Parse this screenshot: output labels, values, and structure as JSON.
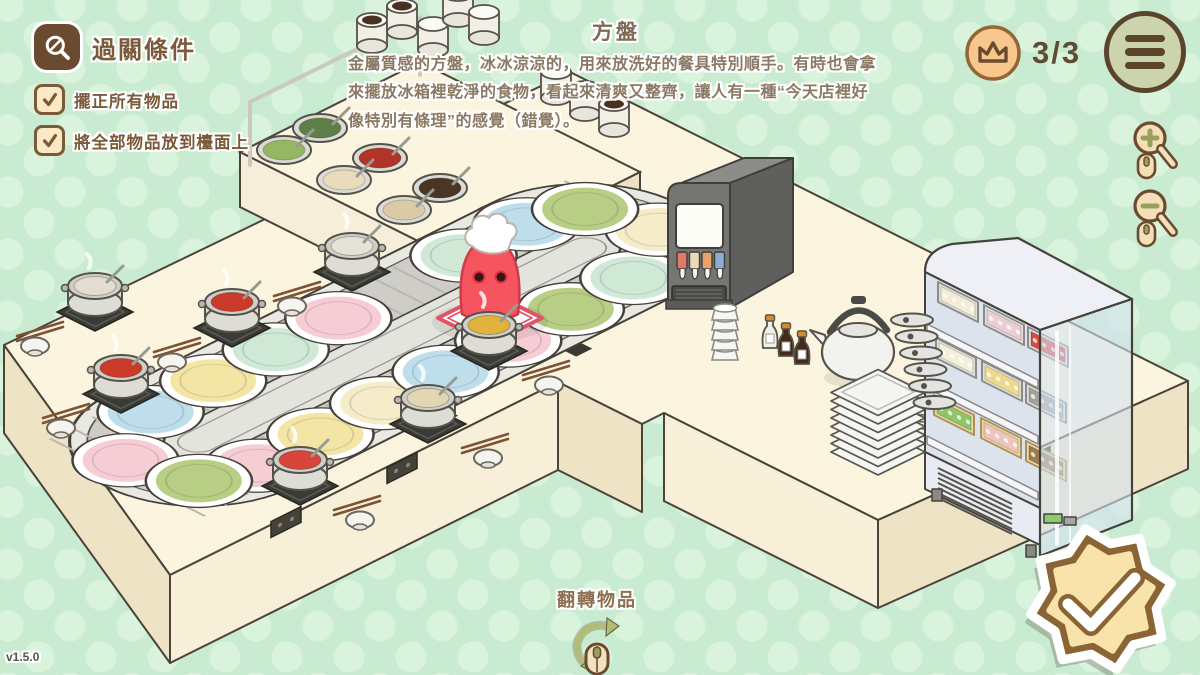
{
  "meta": {
    "version": "v1.5.0"
  },
  "objectives": {
    "title": "過關條件",
    "items": [
      {
        "label": "擺正所有物品",
        "checked": true
      },
      {
        "label": "將全部物品放到檯面上",
        "checked": true
      }
    ]
  },
  "tooltip": {
    "title": "方盤",
    "description": "金屬質感的方盤，冰冰涼涼的，用來放洗好的餐具特別順手。有時也會拿來擺放冰箱裡乾淨的食物，看起來清爽又整齊，讓人有一種“今天店裡好像特別有條理”的感覺（錯覺）。"
  },
  "score": {
    "value": "3/3"
  },
  "hints": {
    "flip_label": "翻轉物品"
  },
  "colors": {
    "accent_brown": "#6b4b2f",
    "badge_orange": "#f7c78d",
    "menu_sage": "#ccd4ae",
    "star_brown": "#8a6434",
    "star_cream": "#f8e3aa",
    "counter_top": "#fbf4df",
    "background": "#c9ebd2"
  },
  "scene": {
    "belt": {
      "plate_colors": {
        "pink": "#f7cdd5",
        "blue": "#bfdeec",
        "green": "#b9ce85",
        "yellow": "#f3e5a4",
        "mint": "#cfe9d6",
        "cream": "#f6ecca"
      },
      "plates": [
        {
          "u": -210,
          "v": -60,
          "c": "blue"
        },
        {
          "u": -140,
          "v": -60,
          "c": "yellow"
        },
        {
          "u": -70,
          "v": -60,
          "c": "mint"
        },
        {
          "u": 0,
          "v": -60,
          "c": "pink"
        },
        {
          "u": 140,
          "v": -60,
          "c": "mint"
        },
        {
          "u": 210,
          "v": -60,
          "c": "blue"
        },
        {
          "u": -210,
          "v": 60,
          "c": "pink"
        },
        {
          "u": -140,
          "v": 60,
          "c": "yellow"
        },
        {
          "u": -70,
          "v": 60,
          "c": "cream"
        },
        {
          "u": 0,
          "v": 60,
          "c": "blue"
        },
        {
          "u": 70,
          "v": 60,
          "c": "pink"
        },
        {
          "u": 140,
          "v": 60,
          "c": "green"
        },
        {
          "u": 210,
          "v": 60,
          "c": "mint"
        },
        {
          "u": -278,
          "v": -20,
          "c": "pink"
        },
        {
          "u": -260,
          "v": 44,
          "c": "green"
        },
        {
          "u": 278,
          "v": 20,
          "c": "cream"
        },
        {
          "u": 260,
          "v": -44,
          "c": "green"
        }
      ]
    },
    "stations": [
      {
        "x": 95,
        "y": 312,
        "soup": "#e2ddd0",
        "side": "left"
      },
      {
        "x": 232,
        "y": 328,
        "soup": "#cc3b2a",
        "side": "left"
      },
      {
        "x": 121,
        "y": 394,
        "soup": "#cc3b2a",
        "side": "left"
      },
      {
        "x": 300,
        "y": 486,
        "soup": "#d8453a",
        "side": "right"
      },
      {
        "x": 428,
        "y": 424,
        "soup": "#e3d6b2",
        "side": "right"
      },
      {
        "x": 489,
        "y": 351,
        "soup": "#e2b23c",
        "side": "right"
      },
      {
        "x": 352,
        "y": 272,
        "soup": "#e6e2d8",
        "side": "left"
      }
    ],
    "condiment_station": {
      "bowls": [
        {
          "x": 320,
          "y": 128,
          "fill": "#5e7f48"
        },
        {
          "x": 380,
          "y": 158,
          "fill": "#b23428"
        },
        {
          "x": 440,
          "y": 188,
          "fill": "#4b3524"
        },
        {
          "x": 500,
          "y": 218,
          "fill": "#b03242"
        },
        {
          "x": 284,
          "y": 150,
          "fill": "#94b862"
        },
        {
          "x": 344,
          "y": 180,
          "fill": "#e8dcbc"
        },
        {
          "x": 404,
          "y": 210,
          "fill": "#dacaa6"
        },
        {
          "x": 464,
          "y": 240,
          "fill": "#eeeade"
        }
      ],
      "canisters": [
        {
          "x": 372,
          "y": 46,
          "top": "dark"
        },
        {
          "x": 402,
          "y": 32,
          "top": "dark"
        },
        {
          "x": 433,
          "y": 50,
          "top": "light"
        },
        {
          "x": 458,
          "y": 20,
          "top": "dark"
        },
        {
          "x": 484,
          "y": 38,
          "top": "light"
        },
        {
          "x": 556,
          "y": 98,
          "top": "light"
        },
        {
          "x": 585,
          "y": 114,
          "top": "light"
        },
        {
          "x": 614,
          "y": 130,
          "top": "dark"
        }
      ]
    },
    "dispenser": {
      "nozzles": [
        "#e0796a",
        "#ead9b6",
        "#e8a26c",
        "#8cacd0"
      ]
    },
    "fridge": {
      "shelf_items": [
        {
          "x": 938,
          "y": 302,
          "fill": "#f2ecd9",
          "wood": false
        },
        {
          "x": 984,
          "y": 325,
          "fill": "#eccdd3",
          "wood": false
        },
        {
          "x": 1028,
          "y": 347,
          "fill": "#d64a42",
          "wood": false
        },
        {
          "x": 936,
          "y": 358,
          "fill": "#f4eedb",
          "wood": false
        },
        {
          "x": 982,
          "y": 381,
          "fill": "#ecd98e",
          "wood": false
        },
        {
          "x": 1026,
          "y": 403,
          "fill": "#a2a29c",
          "wood": false
        },
        {
          "x": 934,
          "y": 415,
          "fill": "#8fc468",
          "wood": true
        },
        {
          "x": 981,
          "y": 438,
          "fill": "#ecc4bc",
          "wood": true
        },
        {
          "x": 1026,
          "y": 461,
          "fill": "#9c7b50",
          "wood": true
        }
      ]
    }
  }
}
